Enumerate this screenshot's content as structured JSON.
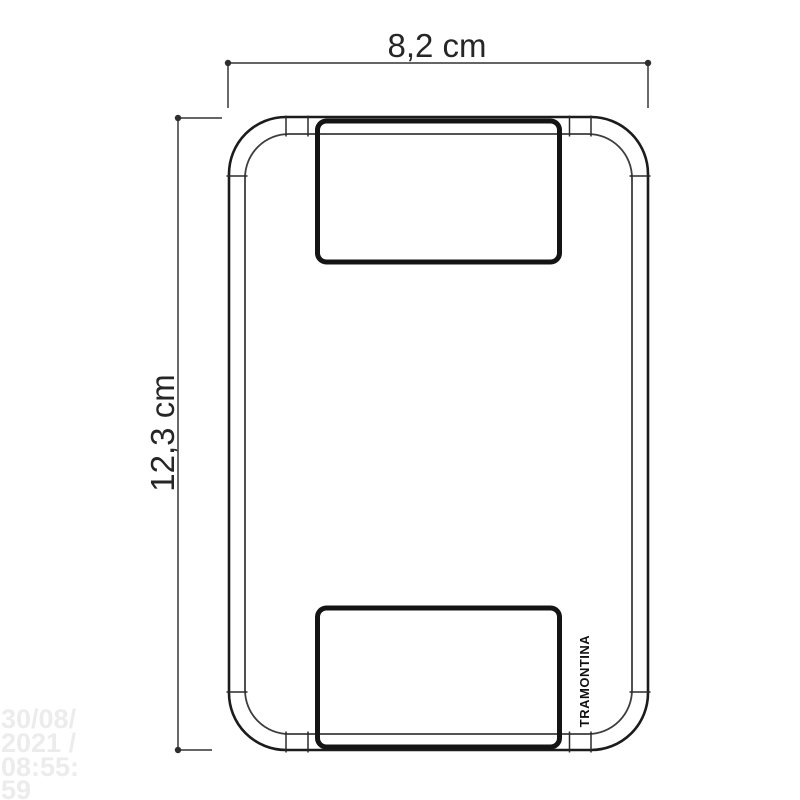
{
  "dimensions": {
    "width": {
      "label": "8,2 cm"
    },
    "height": {
      "label": "12,3 cm"
    }
  },
  "brand": {
    "label": "TRAMONTINA"
  },
  "watermark": {
    "lines": [
      "30/08/",
      "2021 /",
      "08:55:",
      "59"
    ]
  },
  "colors": {
    "background": "#ffffff",
    "outline": "#1c1c1c",
    "inner_outline": "#3d3d3d",
    "module_outline": "#141414",
    "dimension_line": "#4f4f4f",
    "dimension_text": "#262626",
    "brand_text": "#111111",
    "watermark_text": "#ececec"
  }
}
